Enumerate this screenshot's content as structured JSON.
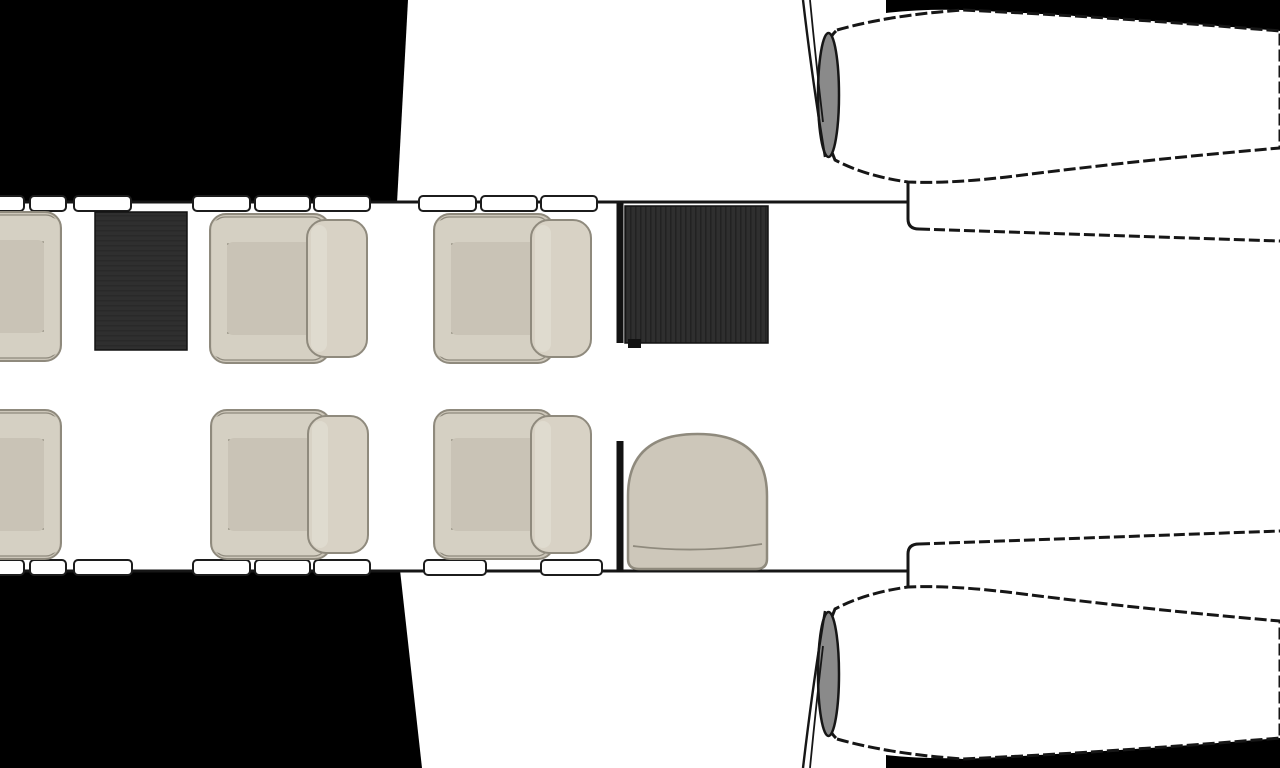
{
  "diagram": {
    "title": "Aircraft cabin floor plan",
    "view": "top-down",
    "nose_direction": "left",
    "description": "Business-jet cabin layout: six club seats in two rows, two dark cabinets, an aft side-facing seat behind a partition, cabin windows along both fuselage walls, wing roots in black and twin aft-mounted engine nacelles"
  },
  "colors": {
    "background": "#ffffff",
    "outline": "#161616",
    "wing_fill": "#000000",
    "cabinet_fill": "#2f2f2f",
    "cabinet_stripe": "#222222",
    "cabinet_stripe_soft": "#292929",
    "cabinet_wall": "#121212",
    "seat_base": "#cdc7ba",
    "seat_arm": "#d5d0c3",
    "seat_cushion": "#c9c3b6",
    "seat_back": "#d8d2c5",
    "seat_highlight": "#e2ddd1",
    "seat_border": "#8f8a7d",
    "seat_base_strip": "#c3bdb0",
    "window_fill": "#ffffff",
    "window_border": "#1c1c1c",
    "engine_body": "#ffffff",
    "engine_inlet": "#8a8a8a"
  },
  "inventory": {
    "club_seat_count": 6,
    "side_seat_count": 1,
    "cabinet_count": 2,
    "partition_count": 2,
    "engine_count": 2,
    "window_count_top": 9,
    "window_count_bottom": 8,
    "seats": [
      {
        "id": "club-seat-fwd-left-window",
        "row": "upper",
        "position": "far forward, clipped at image edge",
        "facing": "aft"
      },
      {
        "id": "club-seat-mid-left-1",
        "row": "upper",
        "position": "mid cabin",
        "facing": "forward"
      },
      {
        "id": "club-seat-mid-left-2",
        "row": "upper",
        "position": "mid-aft cabin",
        "facing": "forward"
      },
      {
        "id": "club-seat-fwd-right-window",
        "row": "lower",
        "position": "far forward, clipped at image edge",
        "facing": "aft"
      },
      {
        "id": "club-seat-mid-right-1",
        "row": "lower",
        "position": "mid cabin",
        "facing": "forward"
      },
      {
        "id": "club-seat-mid-right-2",
        "row": "lower",
        "position": "mid-aft cabin",
        "facing": "forward"
      },
      {
        "id": "aft-side-seat",
        "row": "lower",
        "position": "aft, behind partition",
        "facing": "inboard"
      }
    ]
  }
}
